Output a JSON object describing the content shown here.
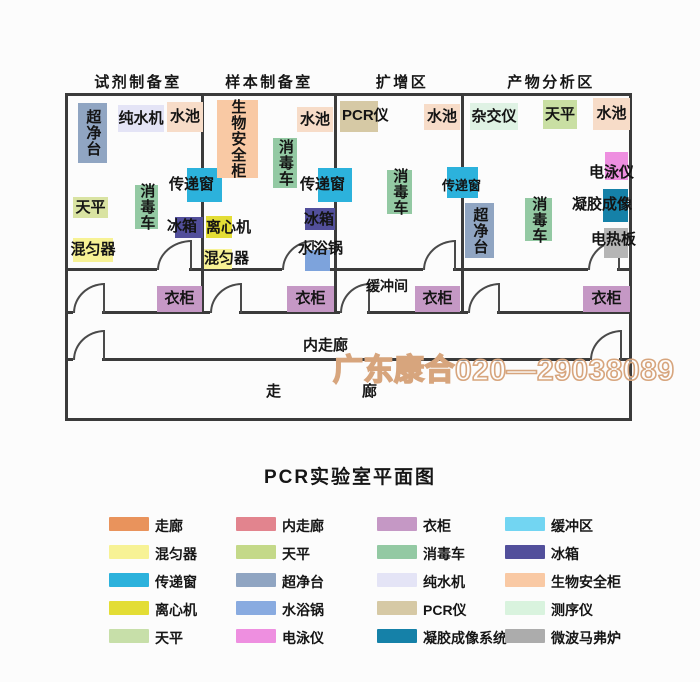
{
  "title": "PCR实验室平面图",
  "watermark": {
    "text": "广东康合020—29038089",
    "stroke_color": "#d7a57d"
  },
  "plan": {
    "room_labels": [
      {
        "text": "试剂制备室",
        "x": 92,
        "y": 71,
        "w": 92
      },
      {
        "text": "样本制备室",
        "x": 222,
        "y": 71,
        "w": 94
      },
      {
        "text": "扩增区",
        "x": 374,
        "y": 71,
        "w": 56
      },
      {
        "text": "产物分析区",
        "x": 504,
        "y": 71,
        "w": 94
      }
    ],
    "area_labels": [
      {
        "text": "缓冲间",
        "x": 366,
        "y": 276,
        "fs": 14
      },
      {
        "text": "内走廊",
        "x": 303,
        "y": 334,
        "fs": 15
      },
      {
        "text": "走",
        "x": 266,
        "y": 380,
        "fs": 15
      },
      {
        "text": "廊",
        "x": 362,
        "y": 380,
        "fs": 15
      }
    ],
    "equipment": [
      {
        "label": "超净台",
        "x": 78,
        "y": 103,
        "w": 29,
        "h": 60,
        "color": "#90a5c2",
        "vertical": true
      },
      {
        "label": "纯水机",
        "x": 118,
        "y": 105,
        "w": 46,
        "h": 27,
        "color": "#e4e4f6"
      },
      {
        "label": "水池",
        "x": 167,
        "y": 102,
        "w": 36,
        "h": 30,
        "color": "#f7dcc8"
      },
      {
        "label": "传递窗",
        "x": 187,
        "y": 168,
        "w": 35,
        "h": 34,
        "color": "#2cb2dc",
        "lx": 169,
        "ly": 177
      },
      {
        "label": "消毒车",
        "x": 135,
        "y": 185,
        "w": 23,
        "h": 44,
        "color": "#93c9a3",
        "vertical": true
      },
      {
        "label": "天平",
        "x": 73,
        "y": 197,
        "w": 35,
        "h": 21,
        "color": "#d9e3a2"
      },
      {
        "label": "冰箱",
        "x": 175,
        "y": 217,
        "w": 28,
        "h": 21,
        "color": "#524f9b",
        "lx": 167,
        "ly": 219
      },
      {
        "label": "混匀器",
        "x": 73,
        "y": 238,
        "w": 40,
        "h": 24,
        "color": "#f7f295"
      },
      {
        "label": "生物安全柜",
        "x": 217,
        "y": 100,
        "w": 41,
        "h": 78,
        "color": "#f9c9a4",
        "vertical": true
      },
      {
        "label": "水池",
        "x": 297,
        "y": 107,
        "w": 36,
        "h": 25,
        "color": "#f7dcc8"
      },
      {
        "label": "消毒车",
        "x": 273,
        "y": 138,
        "w": 24,
        "h": 50,
        "color": "#93c9a3",
        "vertical": true
      },
      {
        "label": "传递窗",
        "x": 318,
        "y": 168,
        "w": 34,
        "h": 34,
        "color": "#2cb2dc",
        "lx": 300,
        "ly": 177
      },
      {
        "label": "离心机",
        "x": 206,
        "y": 216,
        "w": 26,
        "h": 22,
        "color": "#e3dd35",
        "lx": 206,
        "ly": 220
      },
      {
        "label": "冰箱",
        "x": 305,
        "y": 208,
        "w": 30,
        "h": 22,
        "color": "#524f9b",
        "lx": 304,
        "ly": 212
      },
      {
        "label": "混匀器",
        "x": 204,
        "y": 249,
        "w": 28,
        "h": 20,
        "color": "#f7f295",
        "lx": 204,
        "ly": 251
      },
      {
        "label": "水浴锅",
        "x": 305,
        "y": 250,
        "w": 25,
        "h": 21,
        "color": "#7da3dc",
        "lx": 298,
        "ly": 241
      },
      {
        "label": "PCR仪",
        "x": 340,
        "y": 101,
        "w": 38,
        "h": 31,
        "color": "#d6c9a5",
        "lx": 342,
        "ly": 108
      },
      {
        "label": "水池",
        "x": 424,
        "y": 104,
        "w": 36,
        "h": 26,
        "color": "#f7dcc8"
      },
      {
        "label": "消毒车",
        "x": 387,
        "y": 170,
        "w": 25,
        "h": 44,
        "color": "#93c9a3",
        "vertical": true
      },
      {
        "label": "传递窗",
        "x": 447,
        "y": 167,
        "w": 31,
        "h": 31,
        "color": "#2cb2dc",
        "lx": 442,
        "ly": 179,
        "fs": 13
      },
      {
        "label": "杂交仪",
        "x": 470,
        "y": 103,
        "w": 48,
        "h": 27,
        "color": "#dff2e4"
      },
      {
        "label": "天平",
        "x": 543,
        "y": 100,
        "w": 34,
        "h": 29,
        "color": "#c9dfa3"
      },
      {
        "label": "水池",
        "x": 593,
        "y": 98,
        "w": 37,
        "h": 32,
        "color": "#f7dcc8"
      },
      {
        "label": "电泳仪",
        "x": 605,
        "y": 152,
        "w": 23,
        "h": 28,
        "color": "#ee8fe0",
        "lx": 589,
        "ly": 165
      },
      {
        "label": "凝胶成像",
        "x": 603,
        "y": 189,
        "w": 25,
        "h": 33,
        "color": "#1581a8",
        "lx": 572,
        "ly": 197
      },
      {
        "label": "电热板",
        "x": 604,
        "y": 228,
        "w": 24,
        "h": 30,
        "color": "#b5b5b5",
        "lx": 591,
        "ly": 232
      },
      {
        "label": "超净台",
        "x": 465,
        "y": 203,
        "w": 29,
        "h": 55,
        "color": "#90a5c2",
        "vertical": true
      },
      {
        "label": "消毒车",
        "x": 525,
        "y": 198,
        "w": 27,
        "h": 43,
        "color": "#93c9a3",
        "vertical": true
      },
      {
        "label": "衣柜",
        "x": 157,
        "y": 286,
        "w": 45,
        "h": 26,
        "color": "#c598c5"
      },
      {
        "label": "衣柜",
        "x": 287,
        "y": 286,
        "w": 47,
        "h": 26,
        "color": "#c598c5"
      },
      {
        "label": "衣柜",
        "x": 415,
        "y": 286,
        "w": 45,
        "h": 26,
        "color": "#c598c5"
      },
      {
        "label": "衣柜",
        "x": 583,
        "y": 286,
        "w": 47,
        "h": 26,
        "color": "#c598c5"
      }
    ]
  },
  "legend": {
    "col_x": [
      109,
      236,
      377,
      505
    ],
    "row_y": [
      517,
      545,
      573,
      601,
      629
    ],
    "columns": [
      [
        {
          "label": "走廊",
          "color": "#e9935c"
        },
        {
          "label": "混匀器",
          "color": "#f7f295"
        },
        {
          "label": "传递窗",
          "color": "#2cb2dc"
        },
        {
          "label": "离心机",
          "color": "#e3dd35"
        },
        {
          "label": "天平",
          "color": "#c7dfa9"
        }
      ],
      [
        {
          "label": "内走廊",
          "color": "#e2848e"
        },
        {
          "label": "天平",
          "color": "#c4d989"
        },
        {
          "label": "超净台",
          "color": "#90a5c2"
        },
        {
          "label": "水浴锅",
          "color": "#89abe0"
        },
        {
          "label": "电泳仪",
          "color": "#ee8fe0"
        }
      ],
      [
        {
          "label": "衣柜",
          "color": "#c598c5"
        },
        {
          "label": "消毒车",
          "color": "#93c9a3"
        },
        {
          "label": "纯水机",
          "color": "#e4e4f6"
        },
        {
          "label": "PCR仪",
          "color": "#d6c9a5"
        },
        {
          "label": "凝胶成像系统",
          "color": "#1581a8"
        }
      ],
      [
        {
          "label": "缓冲区",
          "color": "#72d5f2"
        },
        {
          "label": "冰箱",
          "color": "#524f9b"
        },
        {
          "label": "生物安全柜",
          "color": "#f9c9a4"
        },
        {
          "label": "测序仪",
          "color": "#d9f3de"
        },
        {
          "label": "微波马弗炉",
          "color": "#acacac"
        }
      ]
    ]
  }
}
